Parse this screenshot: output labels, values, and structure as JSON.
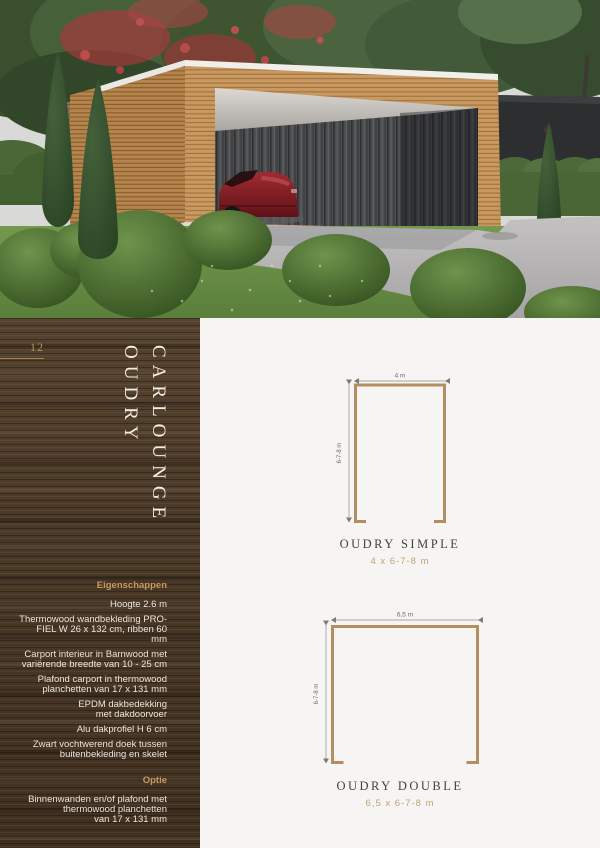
{
  "sidebar": {
    "page_number": "12",
    "title_line1": "OUDRY",
    "title_line2": "CARLOUNGE",
    "specs_heading": "Eigenschappen",
    "specs": [
      "Hoogte 2.6 m",
      "Thermowood wandbekleding PRO-\nFIEL W 26 x 132 cm, ribben 60 mm",
      "Carport interieur in Barnwood met\nvariërende breedte van 10 - 25 cm",
      "Plafond carport in thermowood\nplanchetten van 17 x 131 mm",
      "EPDM dakbedekking\nmet dakdoorvoer",
      "Alu dakprofiel H 6 cm",
      "Zwart vochtwerend doek tussen\nbuitenbekleding en skelet"
    ],
    "option_heading": "Optie",
    "option_item": "Binnenwanden en/of plafond met\nthermowood planchetten\nvan 17 x 131 mm"
  },
  "diagrams": {
    "simple": {
      "title": "OUDRY SIMPLE",
      "subtitle": "4 x 6-7-8 m",
      "width_label": "4 m",
      "height_label": "6-7-8 m"
    },
    "double": {
      "title": "OUDRY DOUBLE",
      "subtitle": "6,5 x 6-7-8 m",
      "width_label": "6,5 m",
      "height_label": "6-7-8 m"
    }
  },
  "colors": {
    "accent_gold": "#c79a5e",
    "diagram_outline": "#b48e60",
    "sidebar_wood": "#4a3827",
    "canvas": "#f6f5f3"
  }
}
